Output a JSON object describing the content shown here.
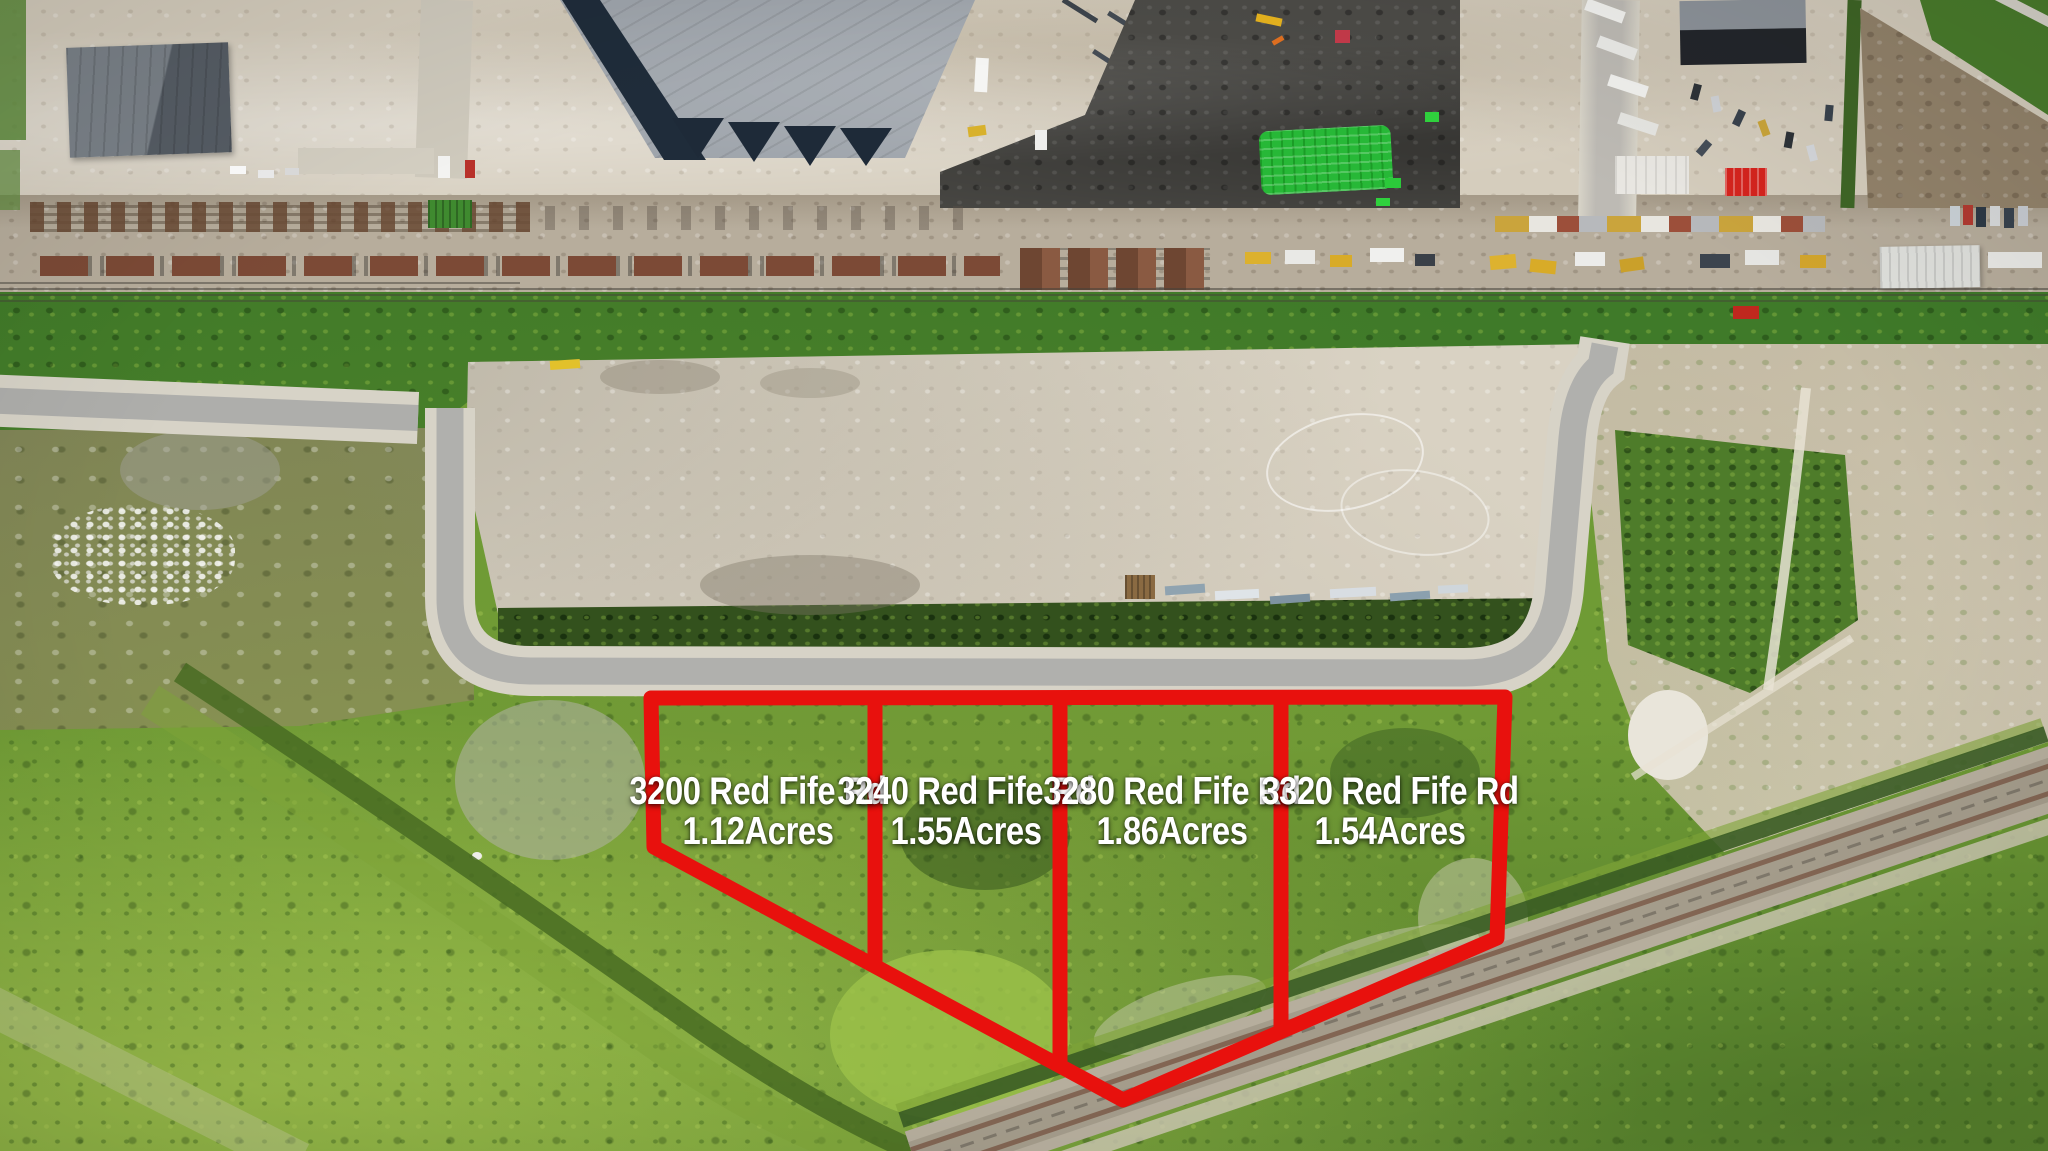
{
  "parcels": [
    {
      "address": "3200 Red Fife Rd",
      "acreage": "1.12Acres"
    },
    {
      "address": "3240 Red Fife Rd",
      "acreage": "1.55Acres"
    },
    {
      "address": "3280 Red Fife Rd",
      "acreage": "1.86Acres"
    },
    {
      "address": "3320 Red Fife Rd",
      "acreage": "1.54Acres"
    }
  ],
  "colors": {
    "outline_red": "#e8110d",
    "label_text": "#ffffff"
  }
}
